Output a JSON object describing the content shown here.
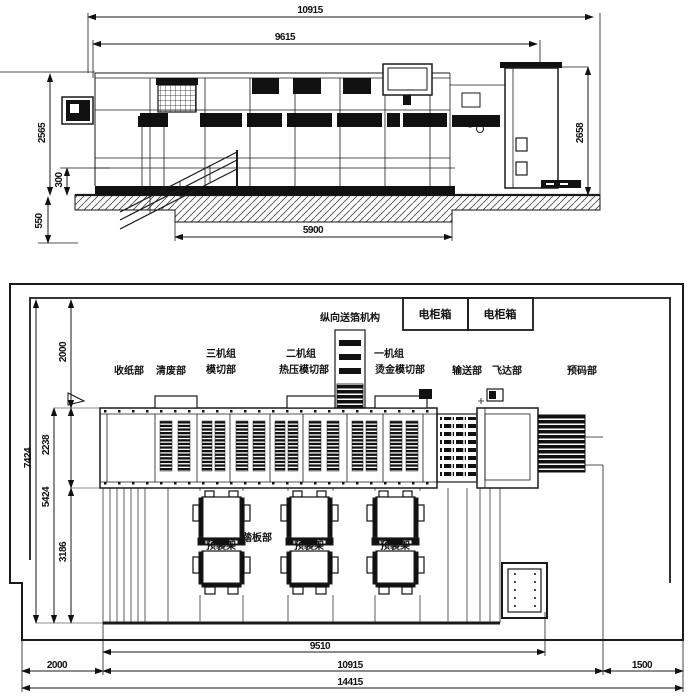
{
  "top_view": {
    "dims": {
      "overall_length": "10915",
      "body_length": "9615",
      "left_height": "2565",
      "right_height": "2658",
      "base_height": "300",
      "foundation_depth": "550",
      "pit_span": "5900"
    }
  },
  "plan_view": {
    "labels": {
      "feed_mechanism": "纵向送箔机构",
      "delivery": "收纸部",
      "stripping": "清废部",
      "unit3_line1": "三机组",
      "unit3_line2": "模切部",
      "unit2_line1": "二机组",
      "unit2_line2": "热压模切部",
      "unit1_line1": "一机组",
      "unit1_line2": "烫金模切部",
      "conveyor": "输送部",
      "feeder": "飞达部",
      "prestack": "预码部",
      "pedal": "踏板部"
    },
    "cabinets": [
      "电柜箱",
      "电柜箱"
    ],
    "racks": [
      "预装架",
      "预装架",
      "预装架"
    ],
    "dims": {
      "rear_clearance": "2000",
      "machine_width": "2238",
      "front_clearance": "3186",
      "width_5424": "5424",
      "width_7424": "7424",
      "machine_length": "9510",
      "left_clearance": "2000",
      "length_10915": "10915",
      "right_clearance": "1500",
      "total_length": "14415"
    }
  },
  "colors": {
    "line": "#1a1a1a",
    "background": "#ffffff"
  }
}
